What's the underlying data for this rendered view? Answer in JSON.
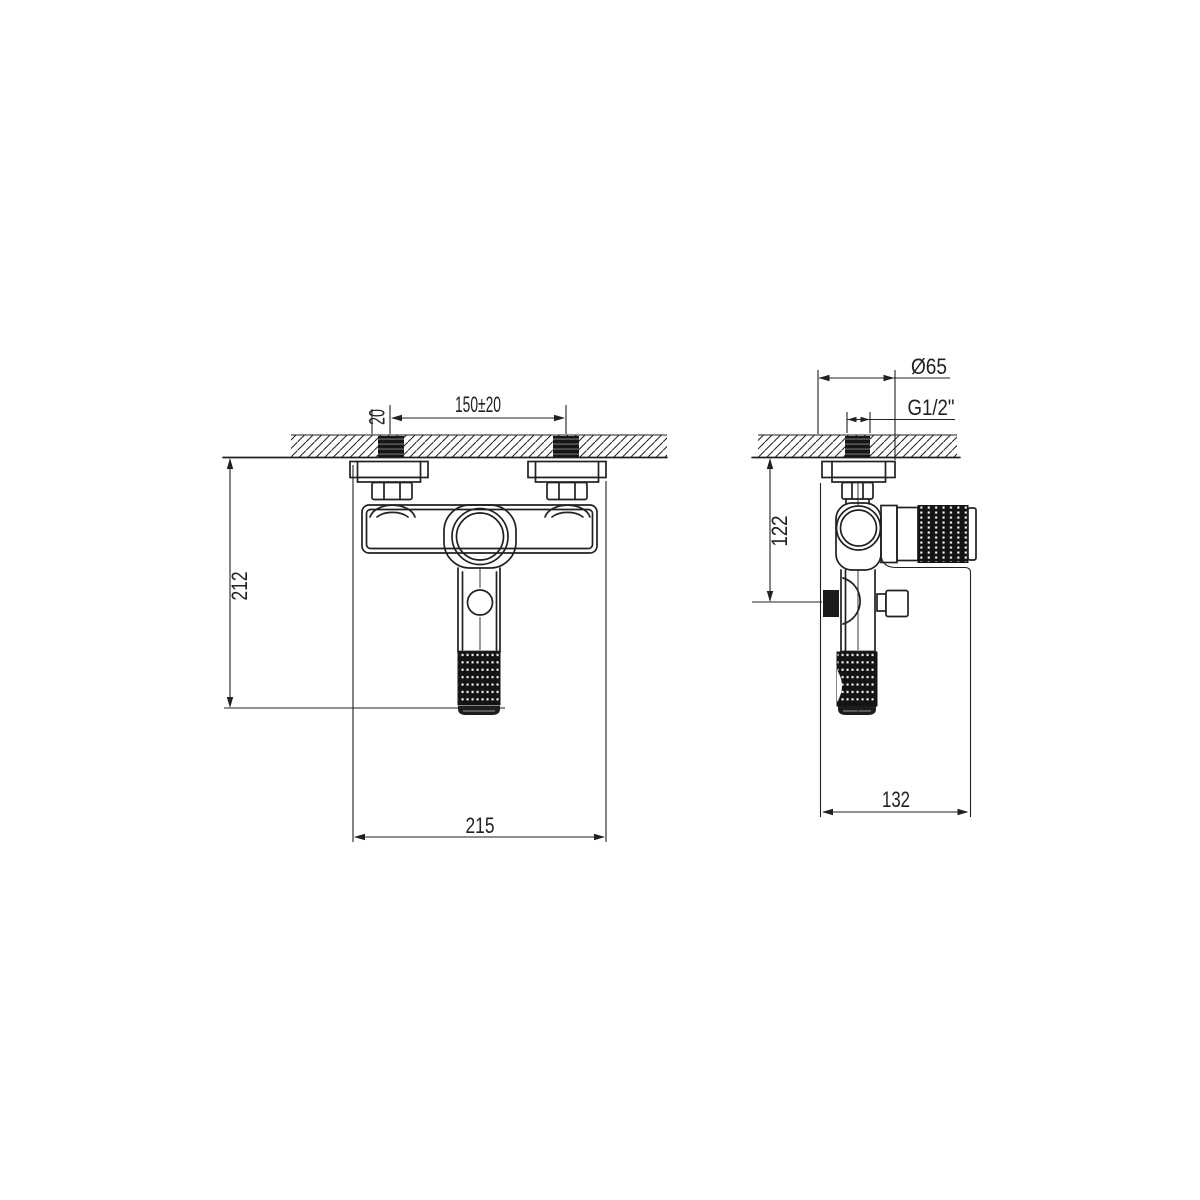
{
  "drawing": {
    "title": "faucet-installation-technical-drawing",
    "background_color": "#ffffff",
    "line_color": "#212121",
    "views": {
      "front": {
        "dims": {
          "stud_offset": "20",
          "stud_spacing": "150±20",
          "drop_height": "212",
          "overall_width": "215"
        }
      },
      "side": {
        "dims": {
          "flange_diameter": "Ø65",
          "thread_size": "G1/2\"",
          "outlet_drop": "122",
          "overall_depth": "132"
        }
      }
    }
  }
}
